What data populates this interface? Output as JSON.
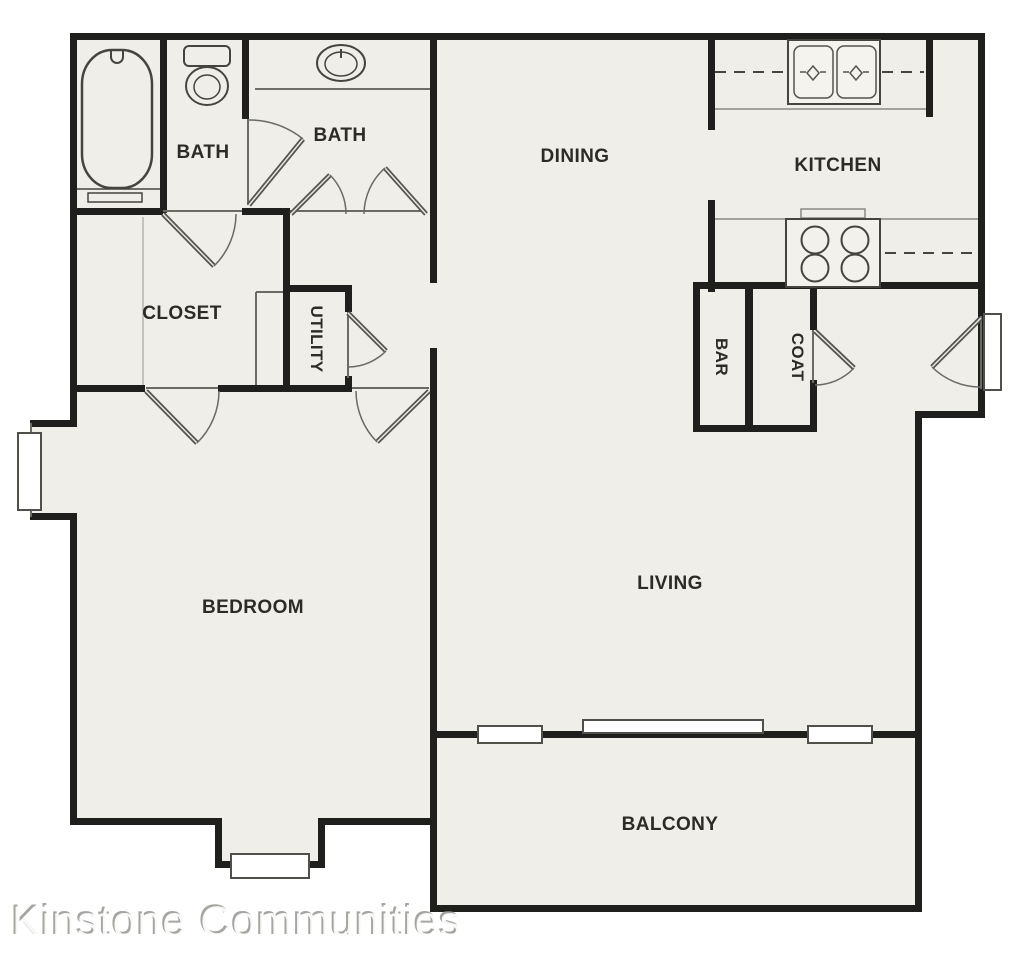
{
  "floor_plan": {
    "title": "One-bedroom apartment floor plan",
    "rooms": {
      "bath1": {
        "label": "BATH"
      },
      "bath2": {
        "label": "BATH"
      },
      "dining": {
        "label": "DINING"
      },
      "kitchen": {
        "label": "KITCHEN"
      },
      "closet": {
        "label": "CLOSET"
      },
      "utility": {
        "label": "UTILITY"
      },
      "bar": {
        "label": "BAR"
      },
      "coat": {
        "label": "COAT"
      },
      "bedroom": {
        "label": "BEDROOM"
      },
      "living": {
        "label": "LIVING"
      },
      "balcony": {
        "label": "BALCONY"
      }
    },
    "fixtures": [
      "bathtub",
      "toilet",
      "vanity-sink",
      "oval-sink",
      "double-kitchen-sink",
      "stove-4-burner",
      "refrigerator-alcove",
      "sliding-glass-door",
      "bay-window-left",
      "bay-window-bottom",
      "balcony-windows",
      "entry-door"
    ],
    "colors": {
      "floor": "#efeee8",
      "walls": "#1f1f1e",
      "outside": "#ffffff",
      "thin_lines": "#50504b",
      "counter_lines": "#8a8a84"
    }
  },
  "watermark": {
    "text": "Kinstone Communities"
  }
}
